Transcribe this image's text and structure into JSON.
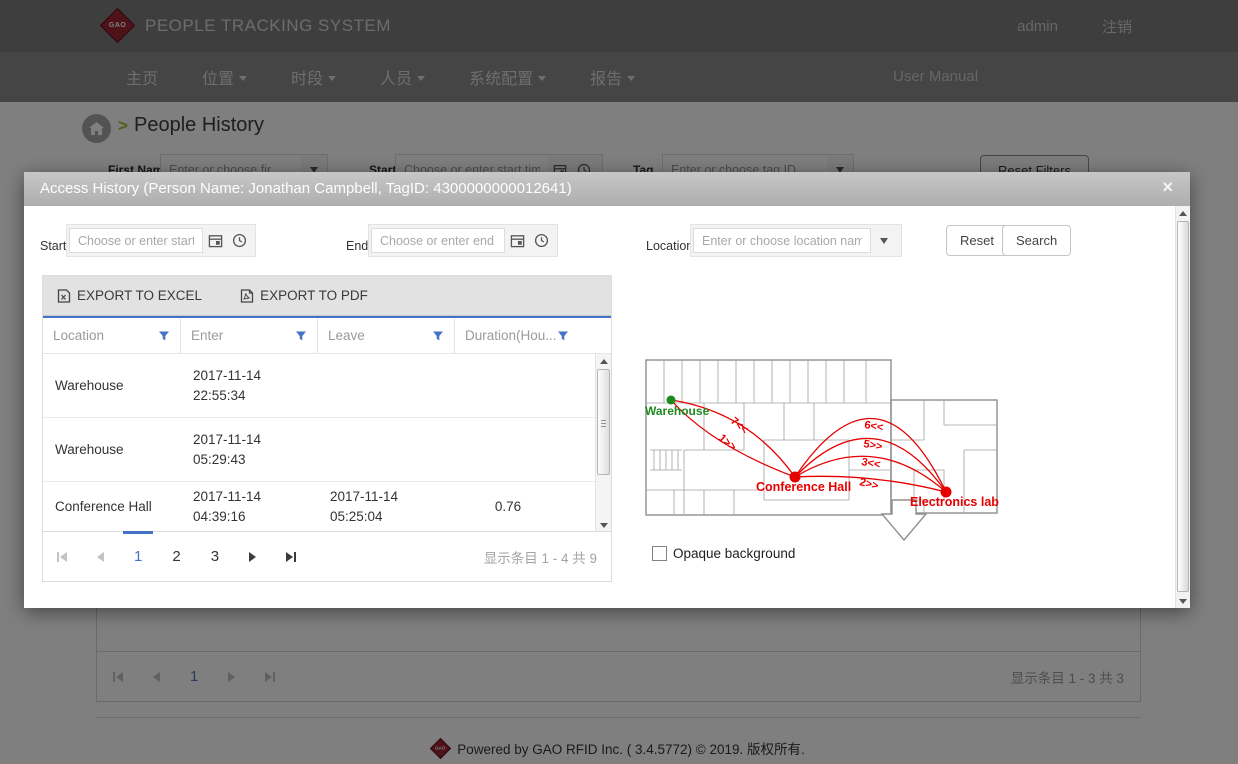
{
  "colors": {
    "accent": "#4472c4",
    "brand-red": "#9c2433",
    "header-bg": "#7d7d7d",
    "nav-bg": "#8b8b8b",
    "olive": "#a8b838",
    "map-red": "#e60000",
    "map-green": "#1e8a1e"
  },
  "header": {
    "logo": "GAO",
    "title": "PEOPLE TRACKING SYSTEM",
    "user": "admin",
    "logout": "注销",
    "nav": {
      "home": "主页",
      "location": "位置",
      "period": "时段",
      "people": "人员",
      "system_config": "系统配置",
      "report": "报告",
      "user_manual": "User Manual"
    }
  },
  "page": {
    "title": "People History",
    "filters": {
      "first_name_label": "First Name",
      "first_name_placeholder": "Enter or choose fir...",
      "start_label": "Start",
      "start_placeholder": "Choose or enter start time",
      "tag_label": "Tag",
      "tag_placeholder": "Enter or choose tag ID",
      "reset_button": "Reset Filters"
    },
    "pager": {
      "page1": "1",
      "summary": "显示条目 1 - 3 共 3"
    },
    "footer": {
      "logo": "GAO",
      "text": "Powered by GAO RFID Inc. ( 3.4.5772) © 2019. 版权所有."
    }
  },
  "modal": {
    "title": "Access History (Person Name: Jonathan Campbell, TagID: 4300000000012641)",
    "close": "×",
    "form": {
      "start_label": "Start",
      "start_placeholder": "Choose or enter start time",
      "end_label": "End",
      "end_placeholder": "Choose or enter end time",
      "location_label": "Location",
      "location_placeholder": "Enter or choose location name",
      "reset_button": "Reset",
      "search_button": "Search"
    },
    "toolbar": {
      "export_excel": "EXPORT TO EXCEL",
      "export_pdf": "EXPORT TO PDF"
    },
    "table": {
      "columns": {
        "location": "Location",
        "enter": "Enter",
        "leave": "Leave",
        "duration": "Duration(Hou..."
      },
      "rows": [
        {
          "location": "Warehouse",
          "enter_date": "2017-11-14",
          "enter_time": "22:55:34",
          "leave_date": "",
          "leave_time": "",
          "duration": ""
        },
        {
          "location": "Warehouse",
          "enter_date": "2017-11-14",
          "enter_time": "05:29:43",
          "leave_date": "",
          "leave_time": "",
          "duration": ""
        },
        {
          "location": "Conference Hall",
          "enter_date": "2017-11-14",
          "enter_time": "04:39:16",
          "leave_date": "2017-11-14",
          "leave_time": "05:25:04",
          "duration": "0.76"
        }
      ]
    },
    "pager": {
      "page1": "1",
      "page2": "2",
      "page3": "3",
      "summary": "显示条目 1 - 4 共 9"
    },
    "map": {
      "locations": {
        "warehouse": "Warehouse",
        "conference": "Conference Hall",
        "electronics": "Electronics lab"
      },
      "transitions": {
        "t7": "7<<",
        "t1": "1>>",
        "t6": "6<<",
        "t5": "5>>",
        "t3": "3<<",
        "t2": "2>>"
      },
      "opaque_checkbox": "Opaque background"
    }
  }
}
